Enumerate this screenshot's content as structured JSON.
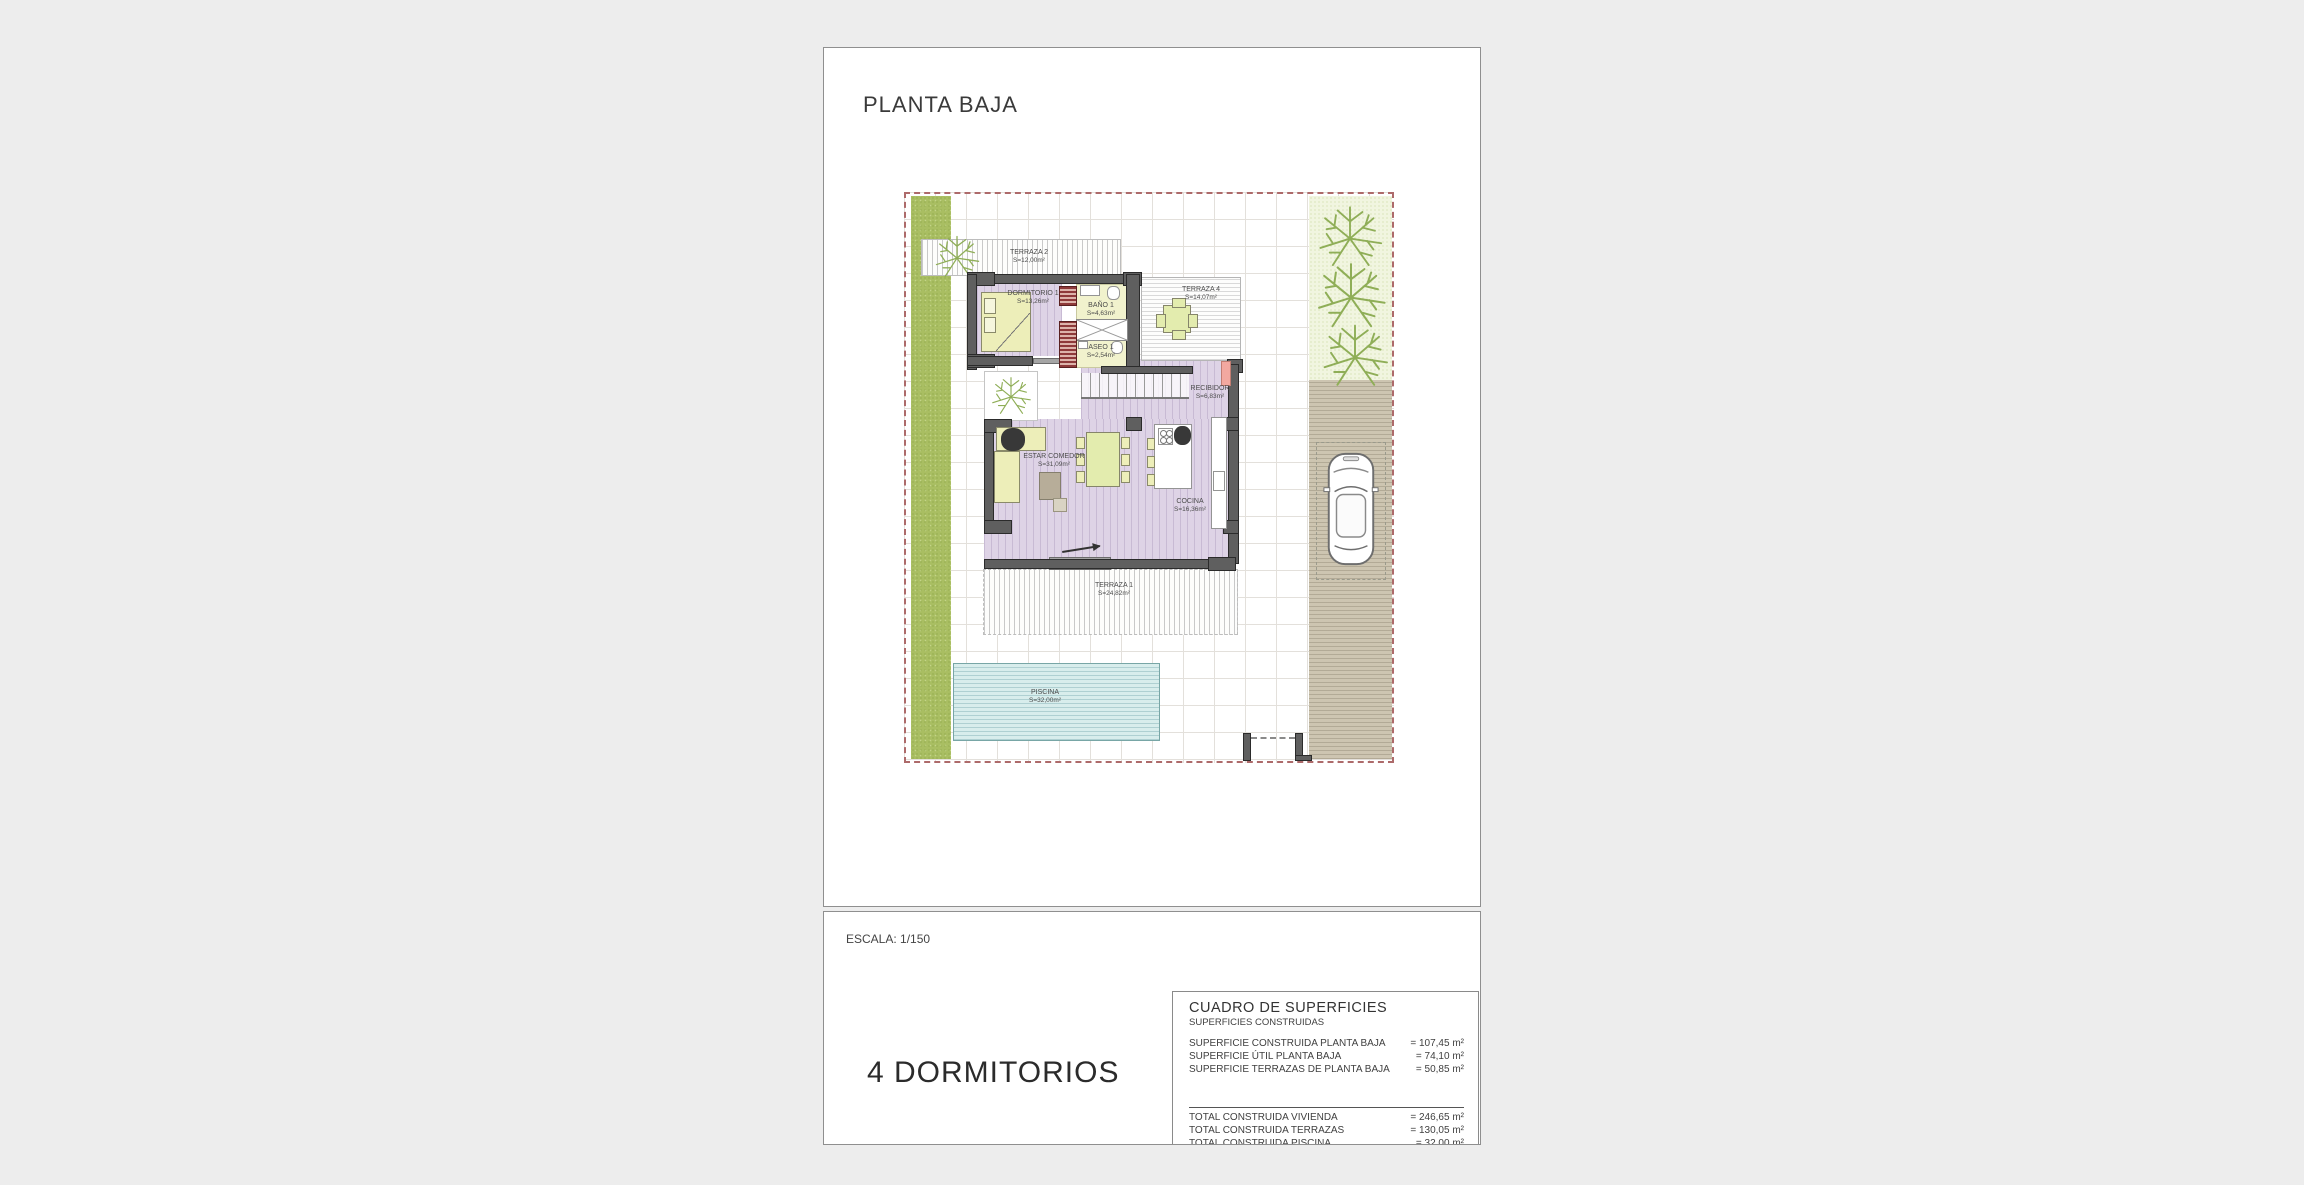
{
  "sheet": {
    "title": "PLANTA BAJA",
    "scale_label": "ESCALA: 1/150",
    "bedrooms_label": "4 DORMITORIOS"
  },
  "rooms": {
    "terraza2": {
      "name": "TERRAZA 2",
      "area": "S=12,00m²"
    },
    "dormitorio1": {
      "name": "DORMITORIO 1",
      "area": "S=13,26m²"
    },
    "bano1": {
      "name": "BAÑO 1",
      "area": "S=4,63m²"
    },
    "aseo1": {
      "name": "ASEO 1",
      "area": "S=2,54m²"
    },
    "terraza4": {
      "name": "TERRAZA 4",
      "area": "S=14,07m²"
    },
    "recibidor": {
      "name": "RECIBIDOR",
      "area": "S=6,83m²"
    },
    "estar": {
      "name": "ESTAR COMEDOR",
      "area": "S=31,09m²"
    },
    "cocina": {
      "name": "COCINA",
      "area": "S=16,36m²"
    },
    "terraza1": {
      "name": "TERRAZA 1",
      "area": "S=24,82m²"
    },
    "piscina": {
      "name": "PISCINA",
      "area": "S=32,00m²"
    }
  },
  "surfaces": {
    "title": "CUADRO DE SUPERFICIES",
    "subtitle": "SUPERFICIES CONSTRUIDAS",
    "rows": [
      {
        "label": "SUPERFICIE CONSTRUIDA PLANTA BAJA",
        "value": "= 107,45 m²"
      },
      {
        "label": "SUPERFICIE ÚTIL PLANTA BAJA",
        "value": "= 74,10 m²"
      },
      {
        "label": "SUPERFICIE TERRAZAS DE PLANTA BAJA",
        "value": "= 50,85 m²"
      }
    ],
    "totals": [
      {
        "label": "TOTAL CONSTRUIDA VIVIENDA",
        "value": "= 246,65 m²"
      },
      {
        "label": "TOTAL CONSTRUIDA TERRAZAS",
        "value": "= 130,05 m²"
      },
      {
        "label": "TOTAL CONSTRUIDA PISCINA",
        "value": "= 32,00 m²"
      }
    ]
  },
  "colors": {
    "floor_lilac": "#ded3e6",
    "wet_yellow": "#f1f2cd",
    "furniture_yellow": "#edeeb9",
    "wall_gray": "#5f5f5f",
    "green_strip": "#a9be62",
    "garden_light": "#f1f5e0",
    "driveway_tan": "#cdc5b1",
    "pool_cyan": "#d8edec",
    "boundary_red": "#ad6a6a",
    "door_salmon": "#f2a8a0"
  }
}
